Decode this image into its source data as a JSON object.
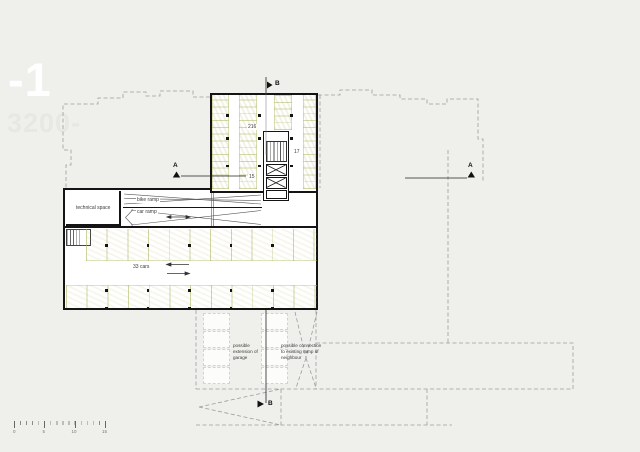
{
  "header": {
    "level": "-1",
    "elevation": "3200-"
  },
  "plan": {
    "upper_garage": {
      "bike_count": "216",
      "count_right": "17",
      "count_left": "15"
    },
    "lower_garage": {
      "capacity": "33 cars",
      "technical_space_label": "technical space",
      "bike_ramp_label": "bike ramp",
      "car_ramp_label": "car ramp"
    },
    "annotations": {
      "extension": "possible extension of garage",
      "connection": "possible connection to existing ramp of neighbour"
    },
    "section_markers": {
      "a_left": "A",
      "a_right": "A",
      "b_top": "B",
      "b_bottom": "B"
    }
  },
  "scale_bar": {
    "ticks": [
      "0",
      "5",
      "10",
      "15"
    ]
  },
  "colors": {
    "background": "#efefec",
    "wall": "#141414",
    "parking_hatch": "#b8c06a",
    "context_line": "#9c9c9c",
    "title_text": "#ffffff"
  }
}
